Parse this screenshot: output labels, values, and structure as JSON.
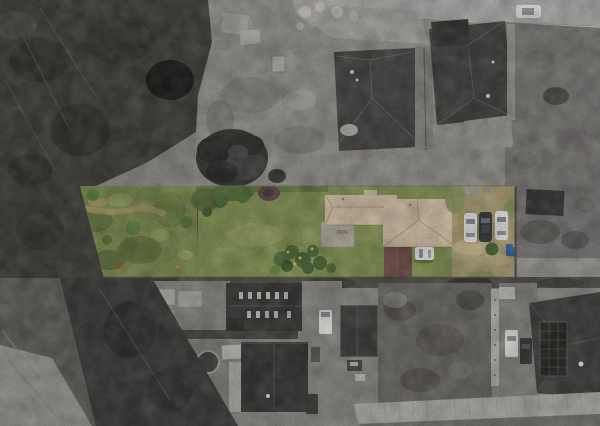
{
  "scene": {
    "type": "aerial-drone-photo",
    "caption": "Top-down aerial photo: a long narrow residential parcel is highlighted in color while all surrounding properties are desaturated grayscale",
    "highlighted_parcel": {
      "features": [
        "overgrown scrub yard (west end)",
        "open lawn",
        "single-story house with tan shingle roof",
        "brown-roofed garage",
        "concrete patio",
        "bare dirt driveway yard (east end)"
      ],
      "parked_vehicles": 4,
      "vehicle_colors": [
        "white",
        "white",
        "dark gray",
        "white"
      ],
      "bins": 2
    },
    "surroundings": [
      "dense dark brush along west side",
      "street along top edge with one parked car",
      "two dark-roofed houses to the north",
      "utility sheds, gardens and warehouse roofs to the south",
      "house with rooftop solar panels at southeast"
    ]
  },
  "palette": {
    "base_gray": "#8f8d8a",
    "road": "#b2b0ae",
    "road_apron": "#a8a6a3",
    "field_gray": "#7e7c79",
    "veg_dark": "#44433f",
    "brush_dark": "#403f3d",
    "tree_gray": "#3a3a38",
    "roof_dark": "#4b4947",
    "roof_dark2": "#474543",
    "yard_gray": "#96948f",
    "pave_light": "#9c9a97",
    "building_roof": "#3e3d3b",
    "building_roof2": "#3a3a39",
    "concrete": "#8e8c89",
    "fence_white": "#b5b3ae",
    "solar_panel": "#2d2d2b",
    "paver_path": "#b1afaa",
    "car_gray_white": "#e8e7e5",
    "parcel": {
      "scrub": "#7e8c52",
      "scrub_dark": "#66773f",
      "lawn": "#869557",
      "lawn_light": "#9aa368",
      "lawn_shadow": "#55673c",
      "tree_green": "#4d6a37",
      "shrub_plum": "#5f4a49",
      "dirt_path": "#a89a66",
      "dirt_yard": "#aea277",
      "dirt_worn": "#bfb188",
      "roof_tan": "#d4c2a8",
      "roof_tan2": "#d6c4aa",
      "roof_ridge": "#b3a085",
      "patio": "#b5afa3",
      "garage_roof": "#7d5a54",
      "hedge_green": "#57723f",
      "flower_yellow": "#d9ca4e",
      "car_white": "#ededeb",
      "car_dark": "#3b3d40",
      "bin_blue": "#3c68a8",
      "bin_teal": "#3a5f73",
      "bush_green": "#465f34"
    }
  }
}
